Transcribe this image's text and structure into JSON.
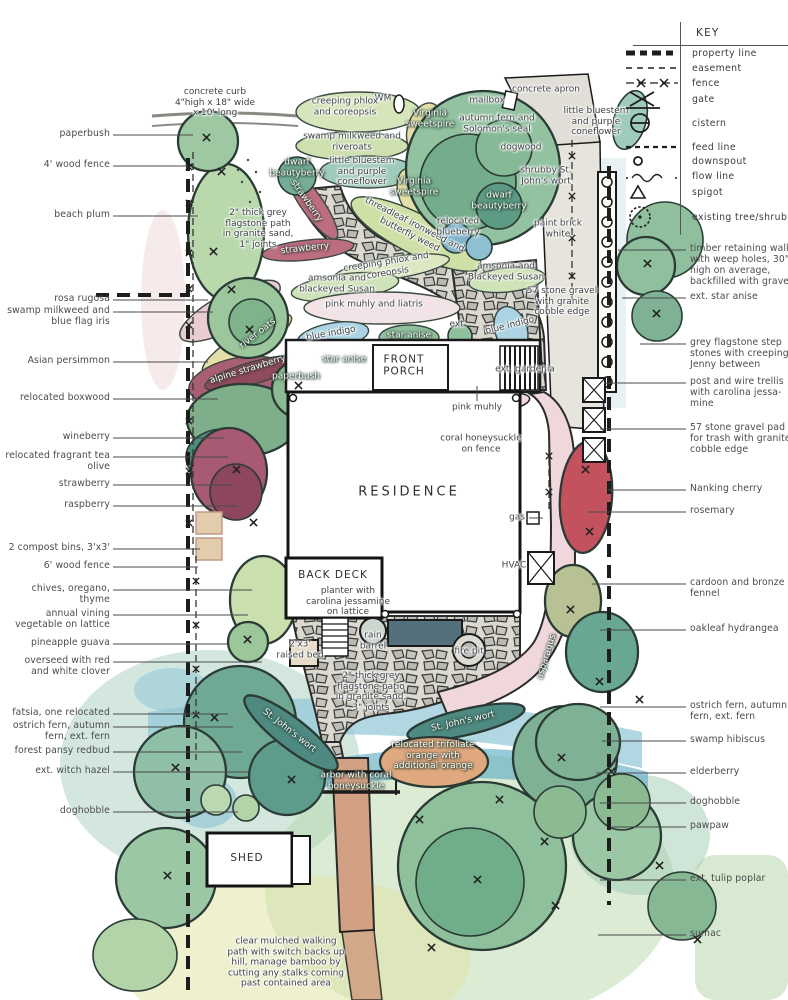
{
  "colors": {
    "ink": "#1d1d1d",
    "label_gray": "#4c4c4c",
    "canopy_green": "#8fbf9d",
    "teal_green": "#4f8a82",
    "pink_path": "#efd7db",
    "maroon": "#a85f74",
    "nanking_red": "#c4525e",
    "water_blue": "#8fc6d6",
    "indigo_blue": "#abd3e3",
    "stone_gray": "#c2c2ba",
    "arbor_tan": "#d2a183",
    "bed_khaki": "#e4dfa8"
  },
  "key": {
    "title": "KEY",
    "items": [
      {
        "symbol": "property-line",
        "label": "property line",
        "y": 53
      },
      {
        "symbol": "easement",
        "label": "easement",
        "y": 68
      },
      {
        "symbol": "fence",
        "label": "fence",
        "y": 83
      },
      {
        "symbol": "gate",
        "label": "gate",
        "y": 99
      },
      {
        "symbol": "cistern",
        "label": "cistern",
        "y": 123
      },
      {
        "symbol": "feed-line",
        "label": "feed line",
        "y": 147
      },
      {
        "symbol": "downspout",
        "label": "downspout",
        "y": 161
      },
      {
        "symbol": "flow-line",
        "label": "flow line",
        "y": 176
      },
      {
        "symbol": "spigot",
        "label": "spigot",
        "y": 192
      },
      {
        "symbol": "existing-tree-shrub",
        "label": "existing tree/shrub",
        "y": 217
      }
    ]
  },
  "left_callouts": [
    {
      "text": "paperbush",
      "y": 135,
      "tx": 193
    },
    {
      "text": "4' wood fence",
      "y": 166,
      "tx": 188
    },
    {
      "text": "beach plum",
      "y": 216,
      "tx": 198
    },
    {
      "text": "rosa rugosa",
      "y": 300,
      "tx": 208
    },
    {
      "text": "swamp milkweed and\nblue flag iris",
      "y": 312,
      "tx": 213
    },
    {
      "text": "Asian persimmon",
      "y": 362,
      "tx": 208
    },
    {
      "text": "relocated boxwood",
      "y": 399,
      "tx": 218
    },
    {
      "text": "wineberry",
      "y": 438,
      "tx": 224
    },
    {
      "text": "relocated fragrant tea\nolive",
      "y": 457,
      "tx": 228
    },
    {
      "text": "strawberry",
      "y": 485,
      "tx": 232
    },
    {
      "text": "raspberry",
      "y": 506,
      "tx": 238
    },
    {
      "text": "2 compost bins, 3'x3'",
      "y": 549,
      "tx": 200
    },
    {
      "text": "6' wood fence",
      "y": 567,
      "tx": 198
    },
    {
      "text": "chives, oregano,\nthyme",
      "y": 590,
      "tx": 252
    },
    {
      "text": "annual vining\nvegetable on lattice",
      "y": 615,
      "tx": 248
    },
    {
      "text": "pineapple guava",
      "y": 644,
      "tx": 228
    },
    {
      "text": "overseed with red\nand white clover",
      "y": 662,
      "tx": 262
    },
    {
      "text": "fatsia, one relocated",
      "y": 714,
      "tx": 228
    },
    {
      "text": "ostrich fern, autumn\nfern, ext. fern",
      "y": 727,
      "tx": 233
    },
    {
      "text": "forest pansy redbud",
      "y": 752,
      "tx": 242
    },
    {
      "text": "ext. witch hazel",
      "y": 772,
      "tx": 248
    },
    {
      "text": "doghobble",
      "y": 812,
      "tx": 238
    }
  ],
  "right_callouts": [
    {
      "text": "timber retaining wall\nwith weep holes, 30\"\nhigh on average,\nbackfilled with gravel",
      "y": 250,
      "tx": 618
    },
    {
      "text": "ext. star anise",
      "y": 298,
      "tx": 622
    },
    {
      "text": "grey flagstone step\nstones with creeping\nJenny between",
      "y": 344,
      "tx": 640
    },
    {
      "text": "post and wire trellis\nwith carolina jessa-\nmine",
      "y": 383,
      "tx": 604
    },
    {
      "text": "57 stone gravel pad\nfor trash with granite\ncobble edge",
      "y": 429,
      "tx": 600
    },
    {
      "text": "Nanking cherry",
      "y": 490,
      "tx": 608
    },
    {
      "text": "rosemary",
      "y": 512,
      "tx": 588
    },
    {
      "text": "cardoon and bronze\nfennel",
      "y": 584,
      "tx": 592
    },
    {
      "text": "oakleaf hydrangea",
      "y": 630,
      "tx": 600
    },
    {
      "text": "ostrich fern, autumn\nfern, ext. fern",
      "y": 707,
      "tx": 600
    },
    {
      "text": "swamp hibiscus",
      "y": 741,
      "tx": 602
    },
    {
      "text": "elderberry",
      "y": 773,
      "tx": 596
    },
    {
      "text": "doghobble",
      "y": 803,
      "tx": 600
    },
    {
      "text": "pawpaw",
      "y": 827,
      "tx": 612
    },
    {
      "text": "ext. tulip poplar",
      "y": 880,
      "tx": 600
    },
    {
      "text": "sumac",
      "y": 935,
      "tx": 598
    }
  ],
  "plan_labels": [
    {
      "t": "concrete curb\n4\"high x 18\" wide\nx 10' long",
      "x": 215,
      "y": 103
    },
    {
      "t": "WM",
      "x": 383,
      "y": 99
    },
    {
      "t": "creeping phlox\nand coreopsis",
      "x": 345,
      "y": 107
    },
    {
      "t": "Virginia\nsweetspire",
      "x": 430,
      "y": 119,
      "light": true
    },
    {
      "t": "mailbox",
      "x": 487,
      "y": 101
    },
    {
      "t": "concrete apron",
      "x": 546,
      "y": 90
    },
    {
      "t": "autumn fern and\nSolomon's seal",
      "x": 497,
      "y": 124
    },
    {
      "t": "little bluestem\nand purple\nconeflower",
      "x": 596,
      "y": 122
    },
    {
      "t": "swamp milkweed and\nriveroats",
      "x": 352,
      "y": 142
    },
    {
      "t": "dogwood",
      "x": 521,
      "y": 148
    },
    {
      "t": "dwarf\nbeautyberry",
      "x": 297,
      "y": 168,
      "light": true
    },
    {
      "t": "little bluestem\nand purple\nconeflower",
      "x": 362,
      "y": 172
    },
    {
      "t": "shrubby St.\nJohn's wort",
      "x": 546,
      "y": 176
    },
    {
      "t": "Virginia\nsweetspire",
      "x": 414,
      "y": 187,
      "light": true
    },
    {
      "t": "dwarf\nbeautyberry",
      "x": 499,
      "y": 201,
      "light": true
    },
    {
      "t": "strawberry",
      "x": 306,
      "y": 201,
      "rot": 55,
      "light": true
    },
    {
      "t": "2\" thick grey\nflagstone path\nin granite sand,\n1\" joints",
      "x": 258,
      "y": 229
    },
    {
      "t": "threadleaf ironweed and\nbutterfly weed",
      "x": 412,
      "y": 230,
      "rot": 27
    },
    {
      "t": "relocated\nblueberry",
      "x": 458,
      "y": 227
    },
    {
      "t": "paint brick\nwhite",
      "x": 558,
      "y": 229
    },
    {
      "t": "strawberry",
      "x": 305,
      "y": 249,
      "rot": -6,
      "light": true
    },
    {
      "t": "creeping phlox and\ncoreopsis",
      "x": 387,
      "y": 268,
      "rot": -9
    },
    {
      "t": "amsonia and\nblackeyed Susan",
      "x": 337,
      "y": 284
    },
    {
      "t": "amsonia and\nBlackeyed Susan",
      "x": 506,
      "y": 272
    },
    {
      "t": "57 stone gravel\nwith granite\ncobble edge",
      "x": 562,
      "y": 302
    },
    {
      "t": "pink muhly and liatris",
      "x": 374,
      "y": 305
    },
    {
      "t": "river oats",
      "x": 258,
      "y": 334,
      "rot": -38,
      "light": true
    },
    {
      "t": "blue indigo",
      "x": 331,
      "y": 334,
      "rot": -10
    },
    {
      "t": "star anise",
      "x": 409,
      "y": 336,
      "light": true
    },
    {
      "t": "ext.",
      "x": 458,
      "y": 325
    },
    {
      "t": "blue indigo",
      "x": 510,
      "y": 326,
      "rot": -14
    },
    {
      "t": "star anise",
      "x": 344,
      "y": 360,
      "light": true
    },
    {
      "t": "alpine strawberry",
      "x": 248,
      "y": 370,
      "rot": -17,
      "light": true
    },
    {
      "t": "paperbush",
      "x": 296,
      "y": 377,
      "light": true
    },
    {
      "t": "ext. gardenia",
      "x": 525,
      "y": 370
    },
    {
      "t": "pink muhly",
      "x": 477,
      "y": 408
    },
    {
      "t": "coral honeysuckle\non fence",
      "x": 481,
      "y": 444
    },
    {
      "t": "gas",
      "x": 517,
      "y": 518
    },
    {
      "t": "HVAC",
      "x": 514,
      "y": 566
    },
    {
      "t": "planter with\ncarolina jessamine\non lattice",
      "x": 348,
      "y": 602
    },
    {
      "t": "2'x3'\nraised bed",
      "x": 300,
      "y": 650
    },
    {
      "t": "rain\nbarrel",
      "x": 373,
      "y": 641
    },
    {
      "t": "fire pit",
      "x": 469,
      "y": 652
    },
    {
      "t": "2\" thick grey\nflagstone patio\nin granite sand,\n3\" joints",
      "x": 371,
      "y": 692
    },
    {
      "t": "asparagus",
      "x": 547,
      "y": 657,
      "rot": -73,
      "light": true
    },
    {
      "t": "St. John's wort",
      "x": 289,
      "y": 731,
      "rot": 38,
      "light": true
    },
    {
      "t": "St. John's wort",
      "x": 463,
      "y": 722,
      "rot": -13,
      "light": true
    },
    {
      "t": "relocated trifoliate\norange with\nadditional orange",
      "x": 433,
      "y": 756,
      "light": true
    },
    {
      "t": "arbor with coral\nhoneysuckle",
      "x": 356,
      "y": 781,
      "light": true
    },
    {
      "t": "clear mulched walking\npath with switch backs up\nhill, manage bamboo by\ncutting any stalks coming\npast contained area",
      "x": 286,
      "y": 963
    },
    {
      "t": "RESIDENCE",
      "x": 409,
      "y": 492,
      "cls": "big"
    },
    {
      "t": "FRONT\nPORCH",
      "x": 404,
      "y": 366,
      "cls": "med"
    },
    {
      "t": "BACK DECK",
      "x": 333,
      "y": 575,
      "cls": "med"
    },
    {
      "t": "SHED",
      "x": 247,
      "y": 858,
      "cls": "med"
    }
  ]
}
